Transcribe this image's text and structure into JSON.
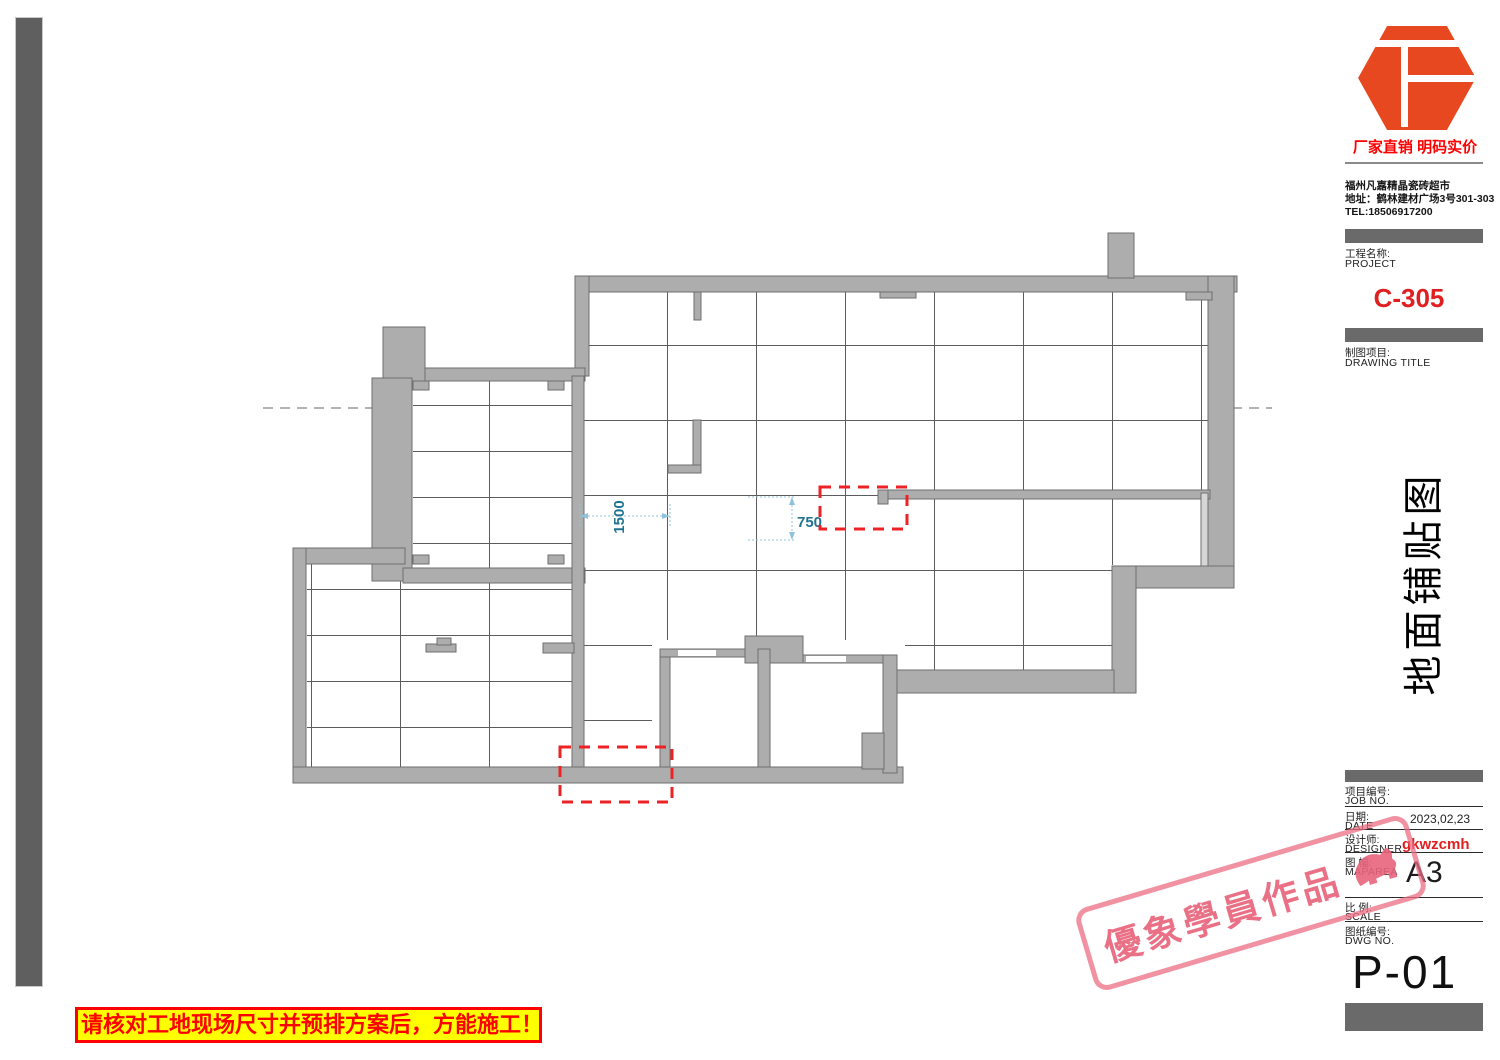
{
  "branding": {
    "slogan": "厂家直销 明码实价",
    "company": "福州凡嘉精晶瓷砖超市",
    "address": "地址：鹤林建材广场3号301-303",
    "tel": "TEL:18506917200",
    "logo_color": "#e8481f"
  },
  "project": {
    "label_zh": "工程名称:",
    "label_en": "PROJECT",
    "code": "C-305"
  },
  "drawing_title_block": {
    "label_zh": "制图项目:",
    "label_en": "DRAWING TITLE"
  },
  "sheet_title_vertical": "地面铺贴图",
  "titleblock": {
    "rows": [
      {
        "zh": "项目编号:",
        "en": "JOB NO.",
        "value": ""
      },
      {
        "zh": "日期:",
        "en": "DATE",
        "value": "2023,02,23"
      },
      {
        "zh": "设计师:",
        "en": "DESIGNER",
        "value": "gkwzcmh"
      },
      {
        "zh": "图 幅:",
        "en": "MAPAREA",
        "value": "A3"
      },
      {
        "zh": "比 例:",
        "en": "SCALE",
        "value": ""
      },
      {
        "zh": "图纸编号:",
        "en": "DWG NO.",
        "value": ""
      }
    ],
    "sheet_number": "P-01"
  },
  "plan": {
    "dim_horizontal": "1500",
    "dim_vertical": "750",
    "dim_color": "#1f7391",
    "wall_color": "#adadad",
    "highlight_color": "#ed2224"
  },
  "stamp": {
    "text": "優象學員作品",
    "color": "#ec6e84"
  },
  "warning": {
    "text": "请核对工地现场尺寸并预排方案后，方能施工！"
  }
}
